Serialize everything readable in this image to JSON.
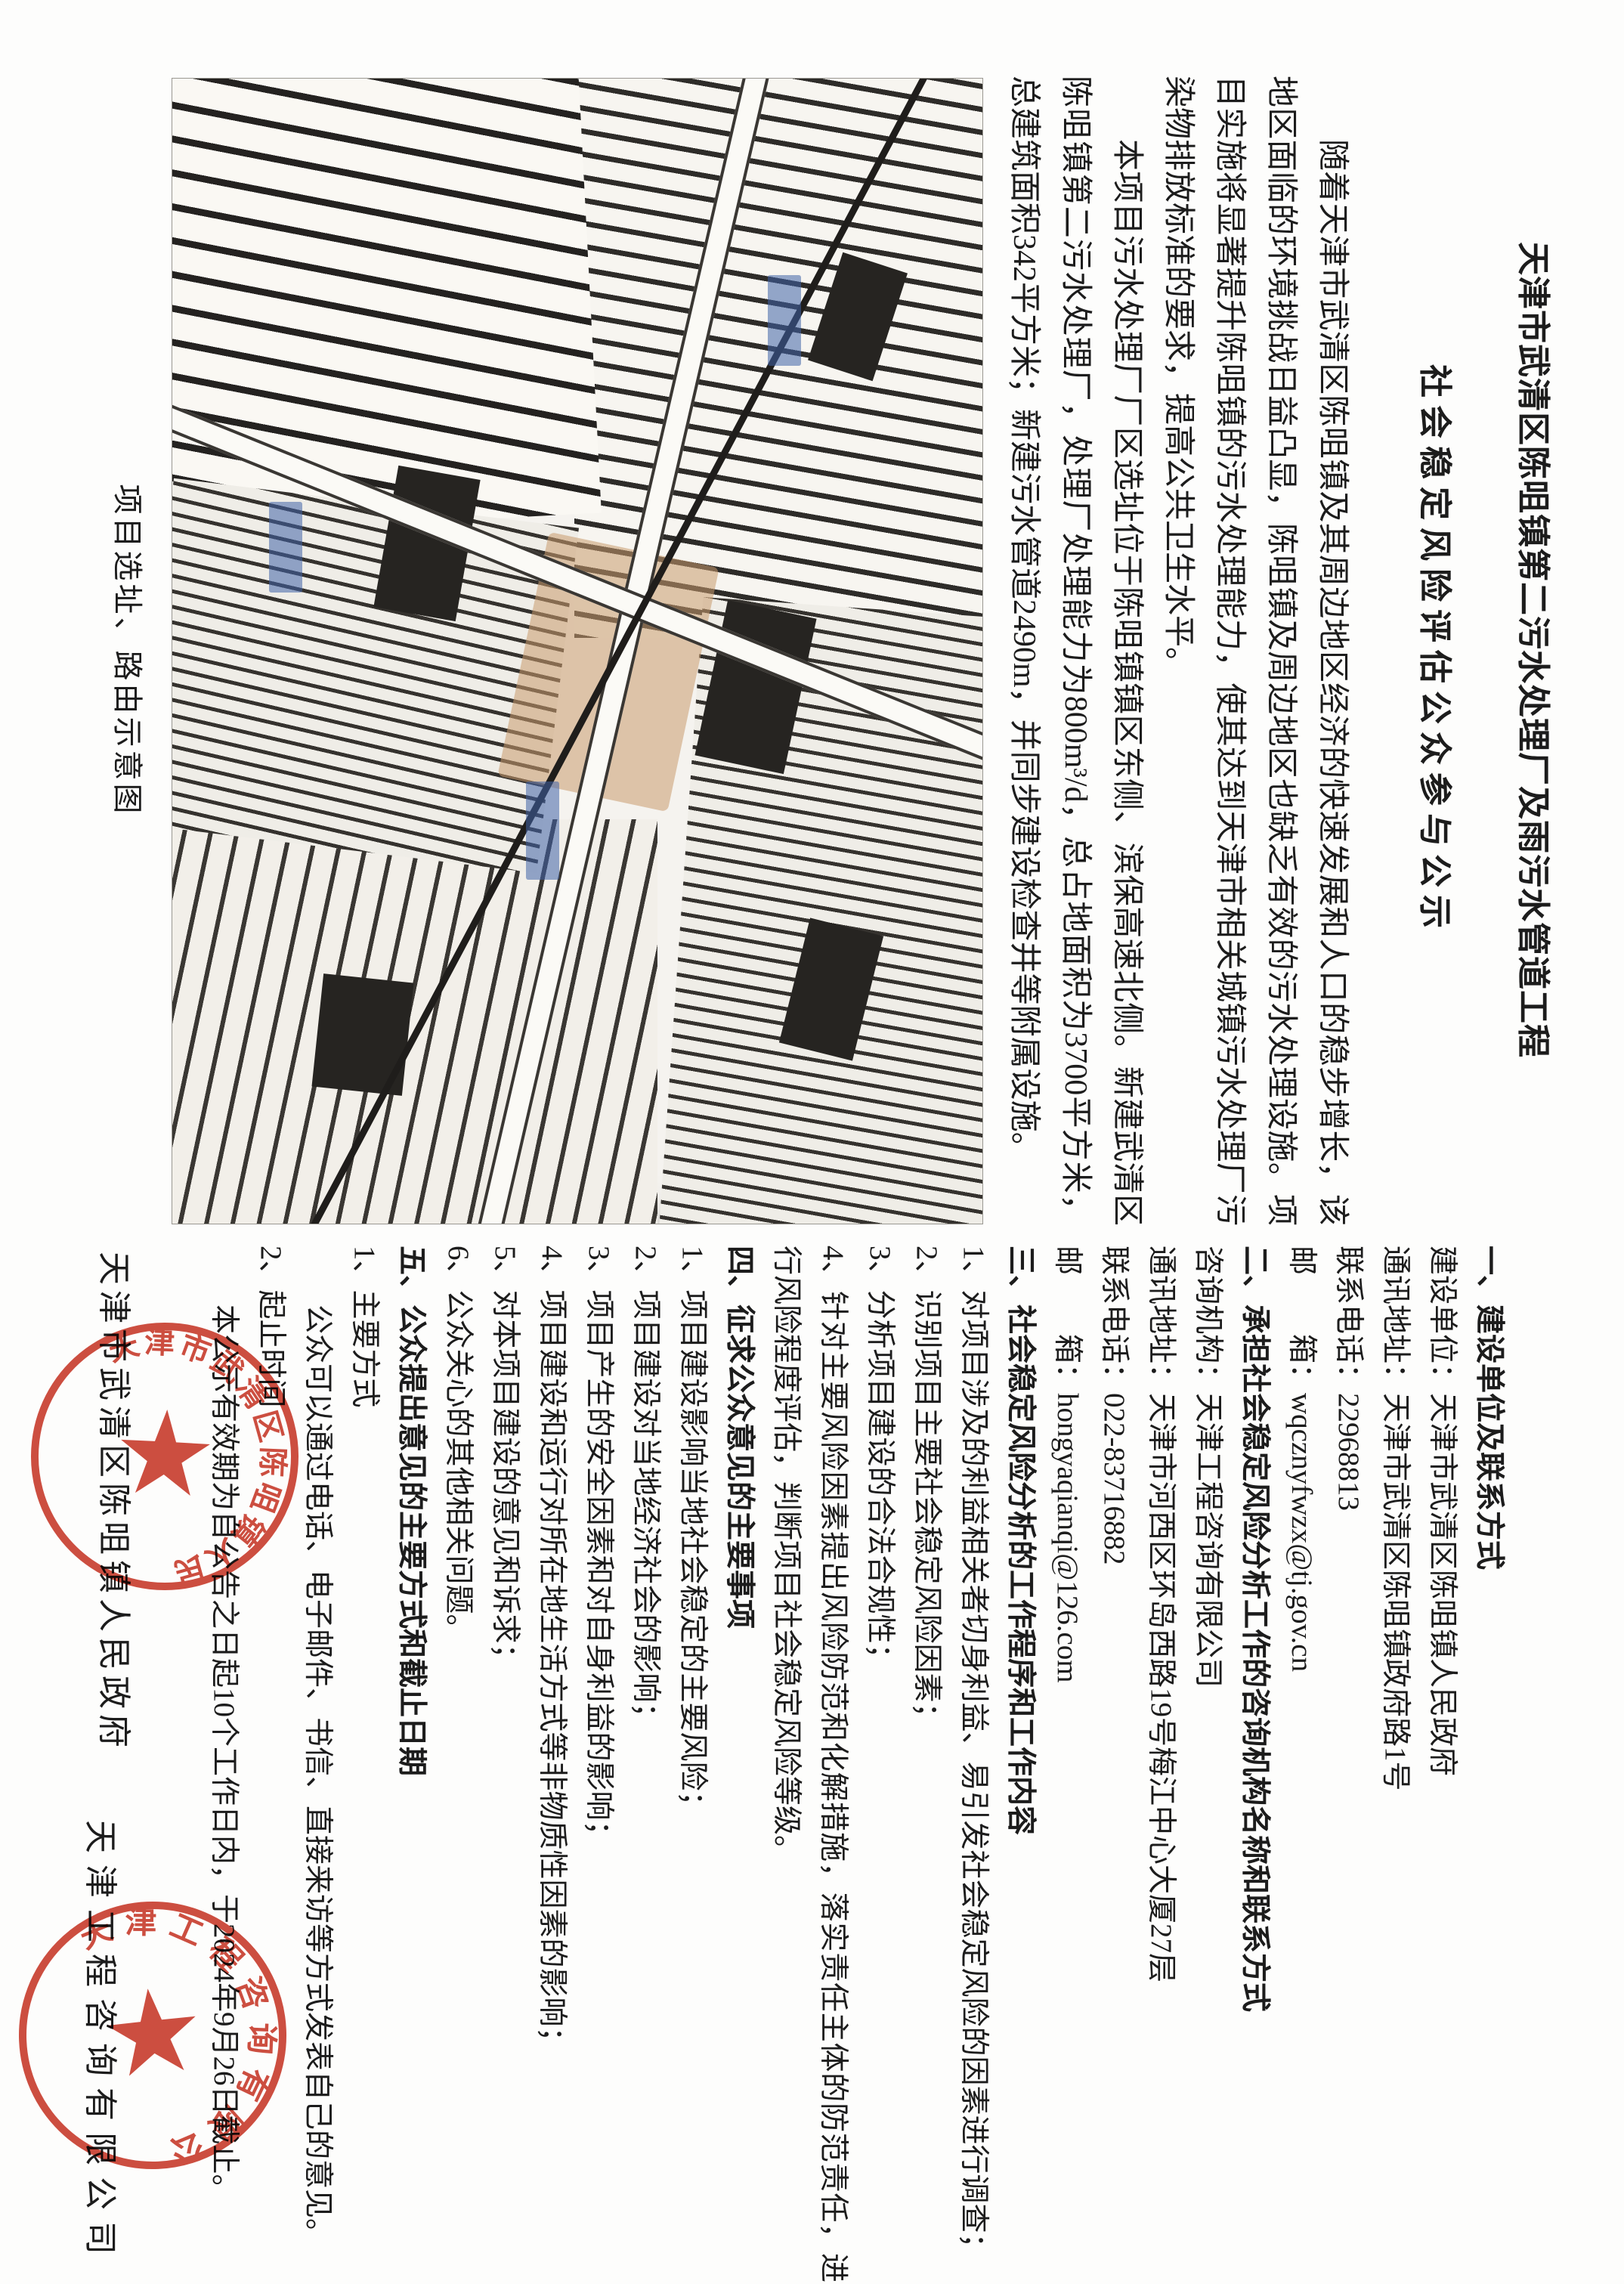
{
  "document": {
    "title_line1": "天津市武清区陈咀镇第二污水处理厂及雨污水管道工程",
    "title_line2": "社会稳定风险评估公众参与公示",
    "paragraphs": [
      "随着天津市武清区陈咀镇及其周边地区经济的快速发展和人口的稳步增长，该地区面临的环境挑战日益凸显，陈咀镇及周边地区也缺乏有效的污水处理设施。项目实施将显著提升陈咀镇的污水处理能力，使其达到天津市相关城镇污水处理厂污染物排放标准的要求，提高公共卫生水平。",
      "本项目污水处理厂厂区选址位于陈咀镇镇区东侧、滨保高速北侧。新建武清区陈咀镇第二污水处理厂，处理厂处理能力为800m³/d，总占地面积为3700平方米，总建筑面积342平方米；新建污水管道2490m，并同步建设检查井等附属设施。"
    ],
    "map_caption": "项目选址、路由示意图",
    "sections": [
      {
        "heading": "一、建设单位及联系方式",
        "lines": [
          "建设单位：天津市武清区陈咀镇人民政府",
          "通讯地址：天津市武清区陈咀镇政府路1号",
          "联系电话：22968813",
          "邮　　箱：wqcznyfwzx@tj.gov.cn"
        ]
      },
      {
        "heading": "二、承担社会稳定风险分析工作的咨询机构名称和联系方式",
        "lines": [
          "咨询机构：天津工程咨询有限公司",
          "通讯地址：天津市河西区环岛西路19号梅江中心大厦27层",
          "联系电话：022-83716882",
          "邮　　箱：hongyaqianqi@126.com"
        ]
      },
      {
        "heading": "三、社会稳定风险分析的工作程序和工作内容",
        "lines": [
          "1、对项目涉及的利益相关者切身利益、易引发社会稳定风险的因素进行调查；",
          "2、识别项目主要社会稳定风险因素；",
          "3、分析项目建设的合法合规性；",
          "4、针对主要风险因素提出风险防范和化解措施，落实责任主体的防范责任，进行风险程度评估，判断项目社会稳定风险等级。"
        ]
      },
      {
        "heading": "四、征求公众意见的主要事项",
        "lines": [
          "1、项目建设影响当地社会稳定的主要风险；",
          "2、项目建设对当地经济社会的影响；",
          "3、项目产生的安全因素和对自身利益的影响；",
          "4、项目建设和运行对所在地生活方式等非物质性因素的影响；",
          "5、对本项目建设的意见和诉求；",
          "6、公众关心的其他相关问题。"
        ]
      },
      {
        "heading": "五、公众提出意见的主要方式和截止日期",
        "lines": [
          "1、主要方式",
          "公众可以通过电话、电子邮件、书信、直接来访等方式发表自己的意见。",
          "2、起止时间",
          "本公示有效期为自公告之日起10个工作日内，于2024年9月26日截止。"
        ]
      }
    ],
    "signatures": {
      "builder": "天津市武清区陈咀镇人民政府",
      "consultant": "天津工程咨询有限公司"
    },
    "stamps": {
      "builder_seal": "天津市武清区陈咀镇人民政府",
      "consultant_seal": "天津工程咨询有限公司"
    },
    "colors": {
      "seal_red": "#c83526",
      "text_black": "#1c1c1c"
    }
  }
}
